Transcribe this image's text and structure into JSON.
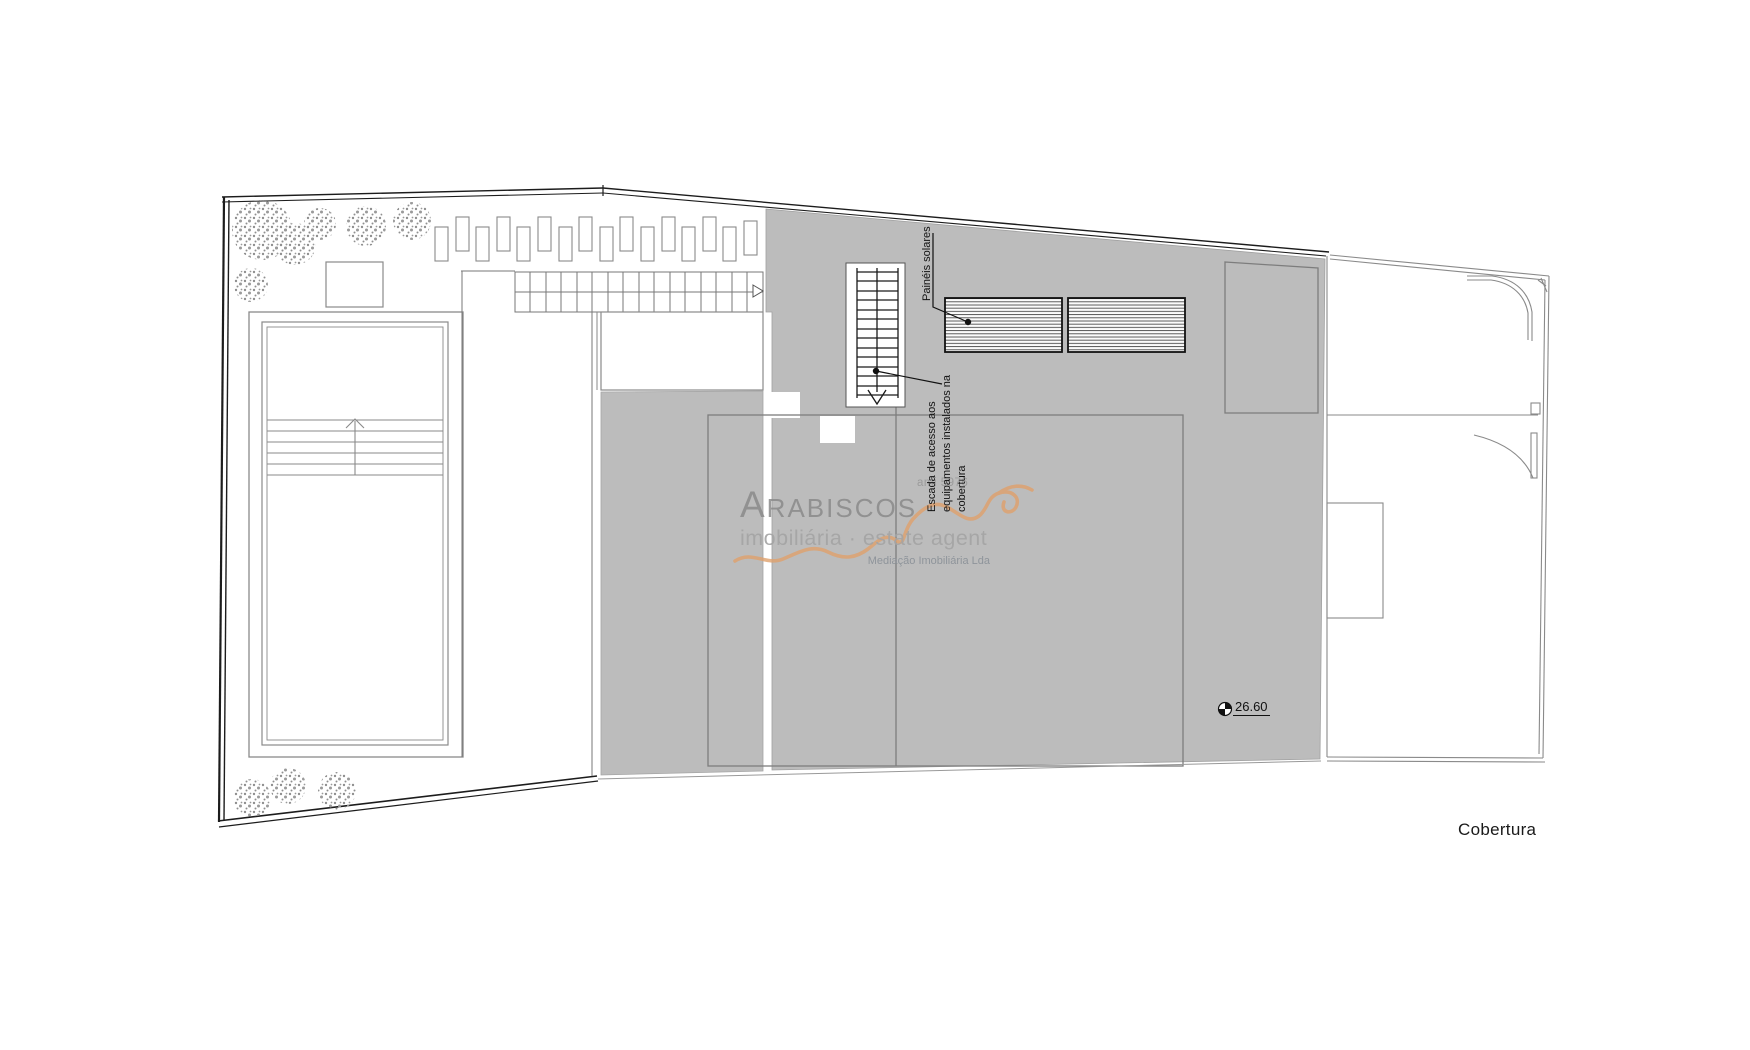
{
  "plan": {
    "title": "Cobertura",
    "labels": {
      "solar_panels": "Painéis solares",
      "stair_note_line1": "Escada de acesso aos",
      "stair_note_line2": "equipamentos instalados na",
      "stair_note_line3": "cobertura",
      "level_value": "26.60"
    },
    "watermark": {
      "license": "ami 5976",
      "brand": "Arabiscos",
      "tagline": "imobiliária · estate agent",
      "company": "Mediação Imobiliária Lda"
    },
    "colors": {
      "roof_gray": "#bcbcbc",
      "line_dark": "#1c1c1c",
      "line_gray": "#8a8a8a",
      "watermark_gray": "#8a8a8a",
      "accent_orange": "#dfa06b"
    }
  }
}
